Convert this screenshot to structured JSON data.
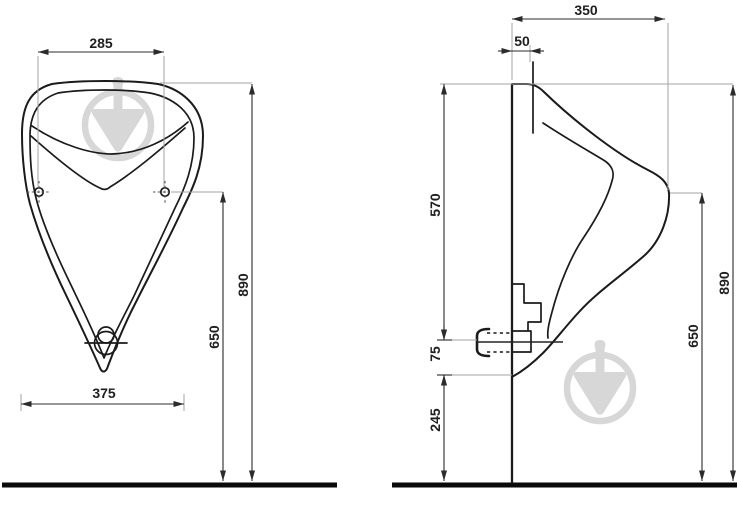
{
  "colors": {
    "background": "#ffffff",
    "outline": "#1b1b1b",
    "dimension_line": "#2b2b2b",
    "reference_line": "#a3a3a3",
    "ground": "#0a0a0a",
    "watermark": "#d7d7d7",
    "text": "#1f1f1f"
  },
  "front_view": {
    "dims": {
      "hole_spacing": "285",
      "total_height": "890",
      "hole_height": "650",
      "bottom_width": "375"
    }
  },
  "side_view": {
    "dims": {
      "depth": "350",
      "inlet_offset": "50",
      "top_to_outlet": "570",
      "outlet_height": "75",
      "outlet_to_floor": "245",
      "total_height": "890",
      "front_edge_height": "650"
    }
  }
}
